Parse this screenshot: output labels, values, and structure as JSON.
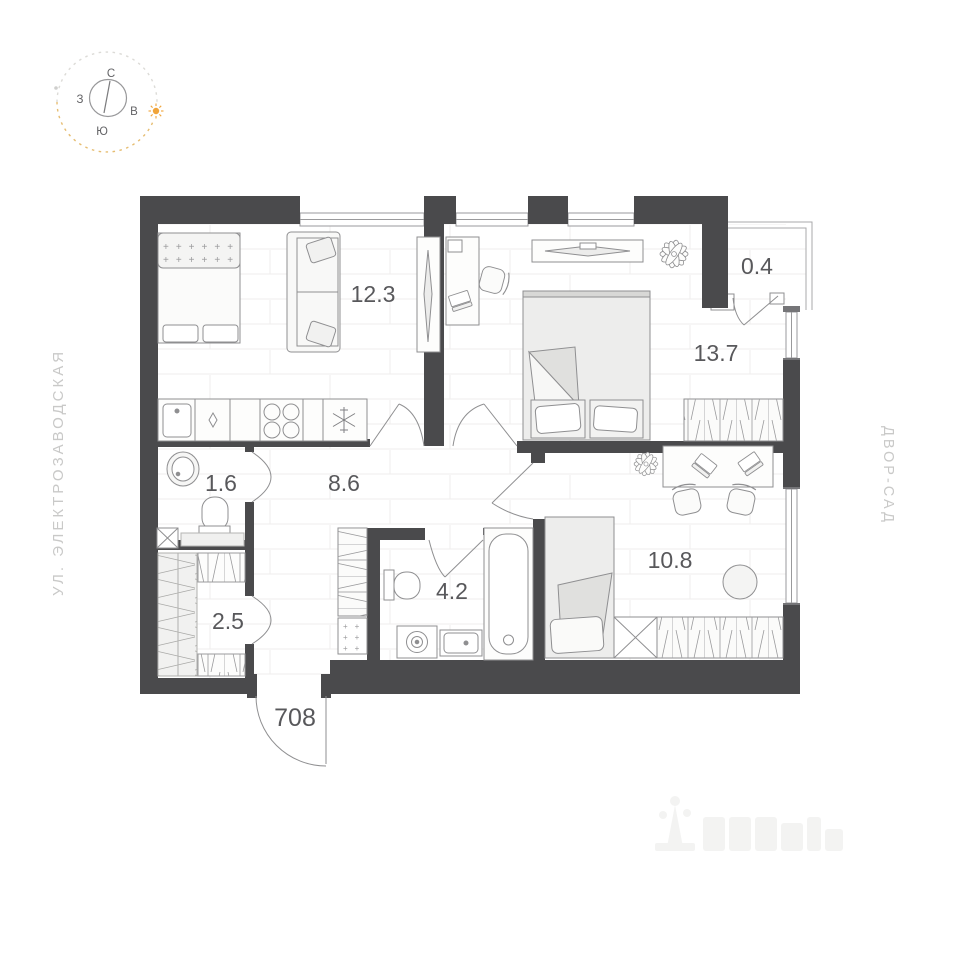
{
  "compass": {
    "north": "С",
    "south": "Ю",
    "east": "В",
    "west": "З"
  },
  "side_labels": {
    "street": "УЛ. ЭЛЕКТРОЗАВОДСКАЯ",
    "courtyard": "ДВОР-САД"
  },
  "entrance": {
    "apartment_number": "708"
  },
  "rooms": {
    "kitchen_living": "12.3",
    "balcony": "0.4",
    "bedroom": "13.7",
    "wc": "1.6",
    "hallway": "8.6",
    "bathroom": "4.2",
    "bedroom2": "10.8",
    "wardrobe": "2.5"
  },
  "colors": {
    "wall": "#4a4a4c",
    "area_label": "#58585b",
    "side_label": "#c9c9c8",
    "furniture_outline": "#8f8f91",
    "floor_line": "#efeeec",
    "sun_accent": "#f0a43a"
  }
}
